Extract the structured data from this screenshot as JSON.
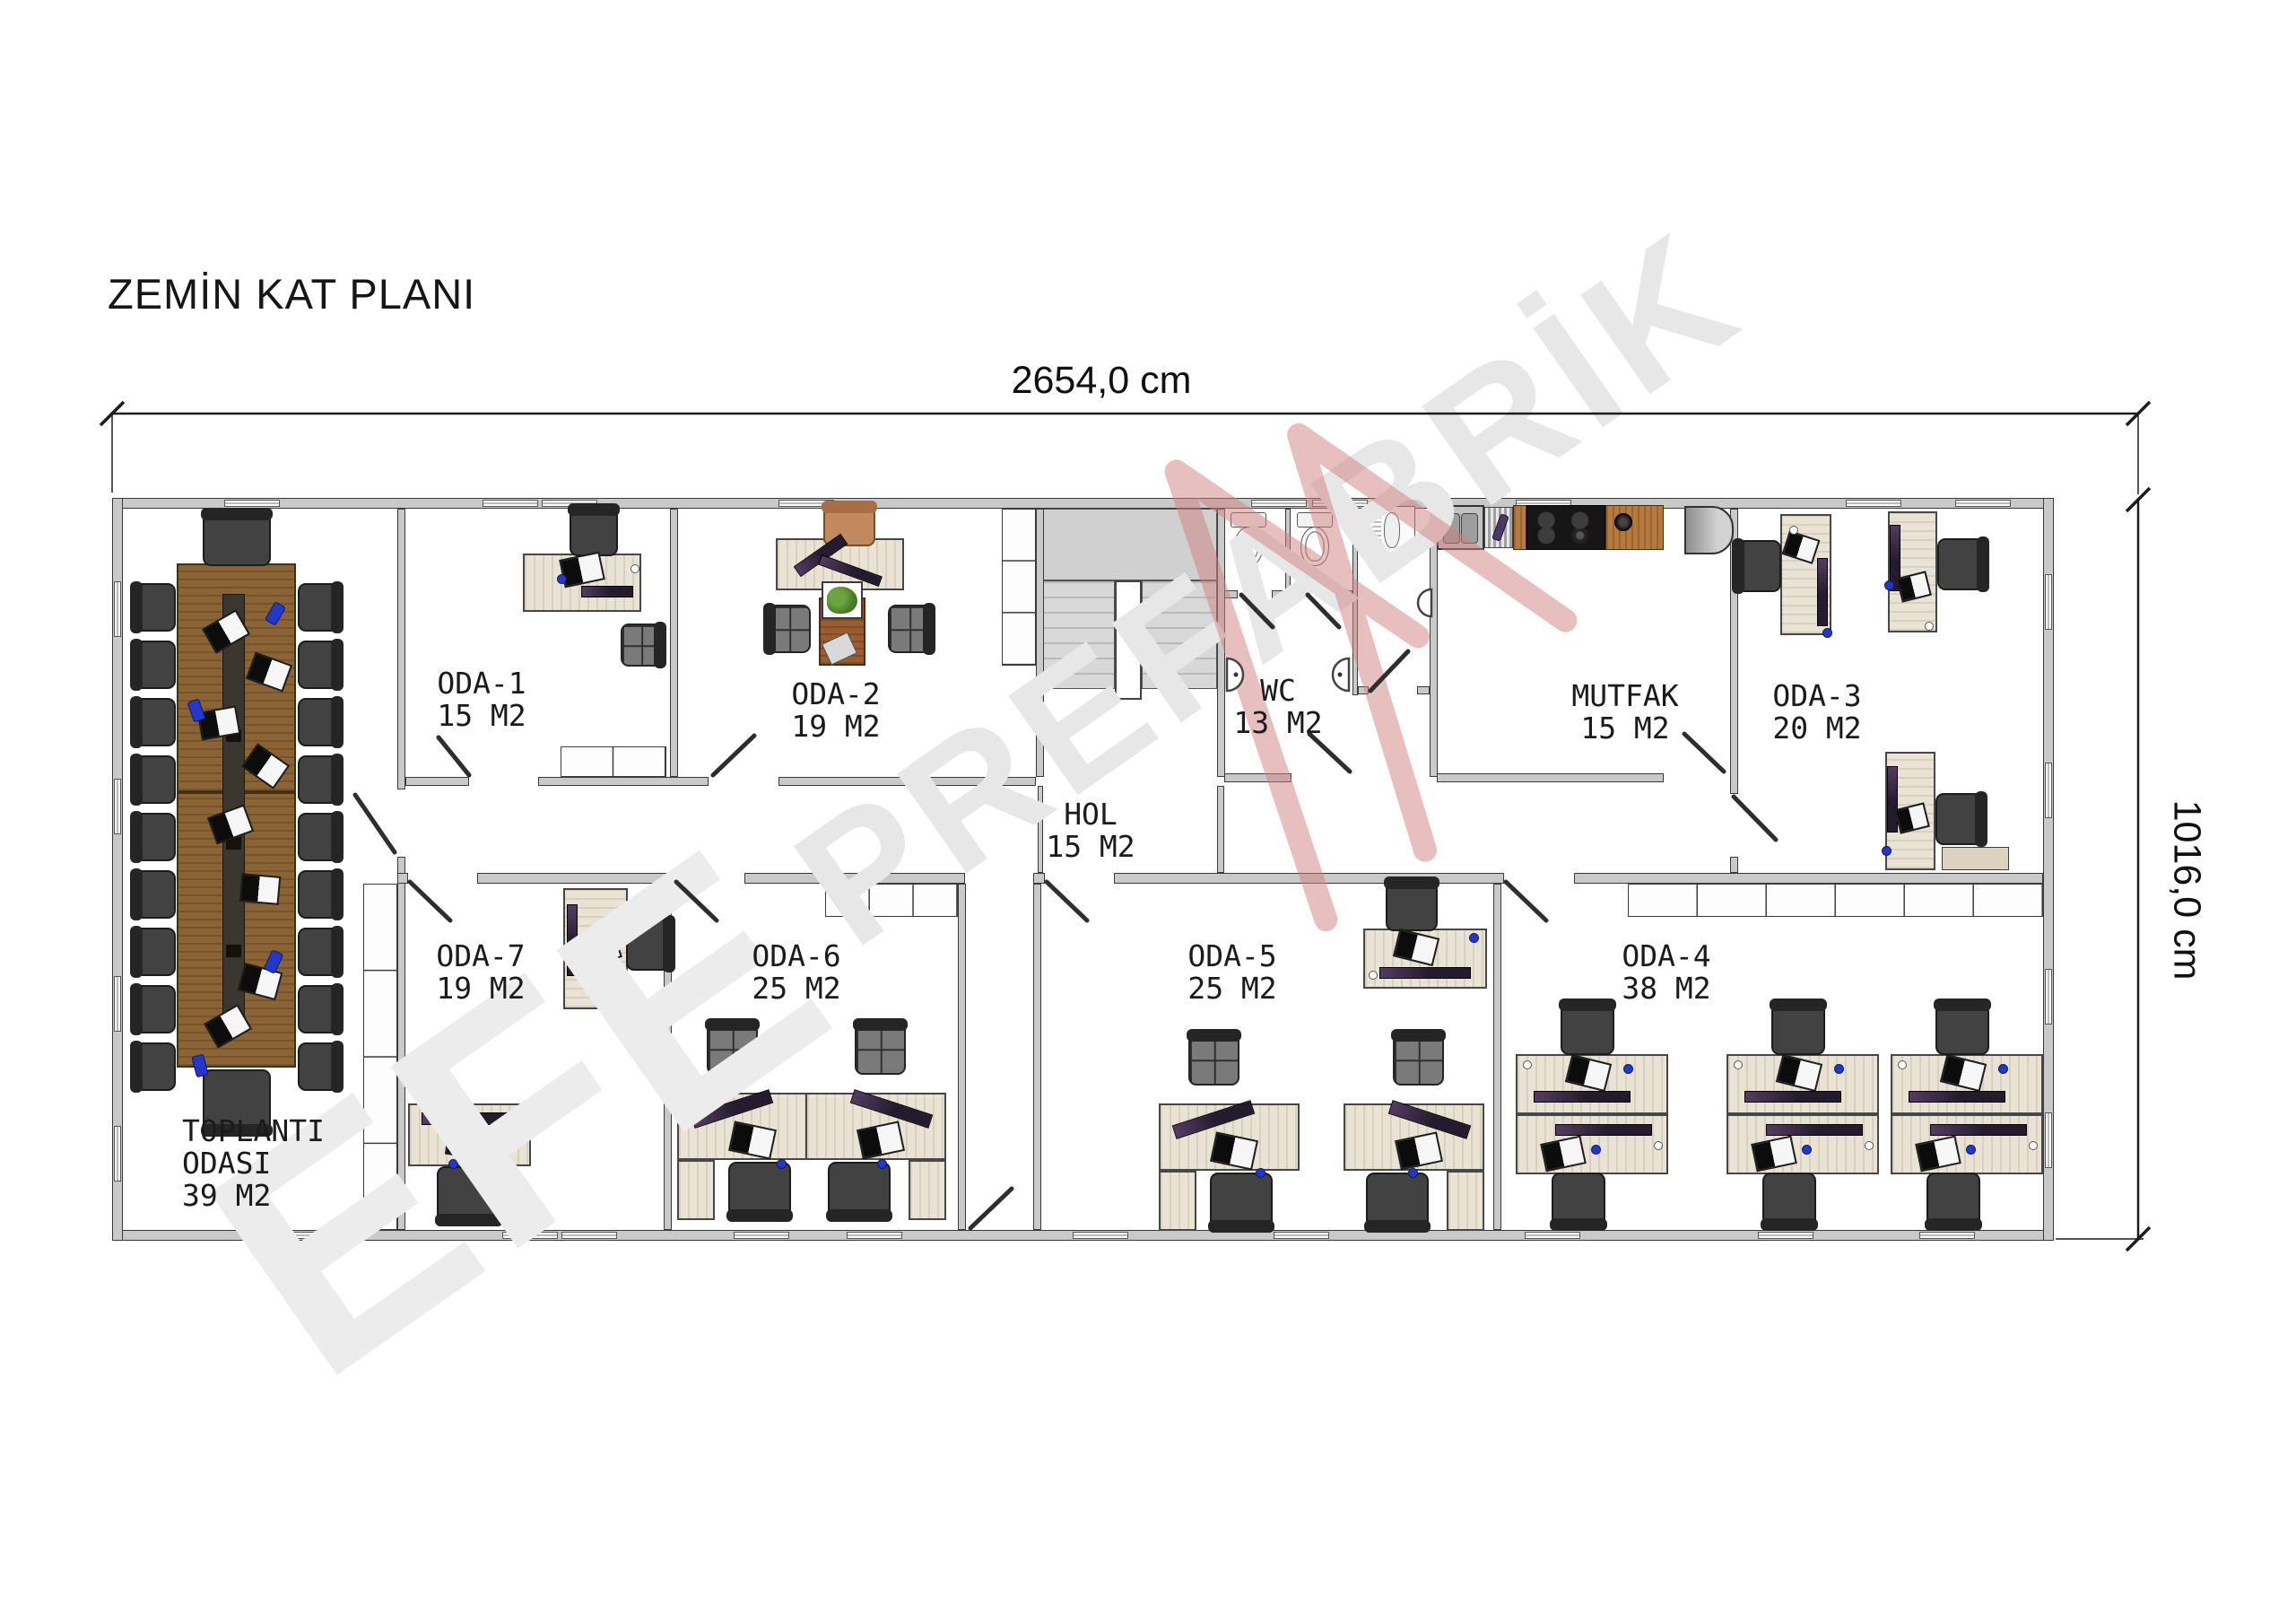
{
  "title": "ZEMİN KAT PLANI",
  "dimensions": {
    "width_label": "2654,0 cm",
    "height_label": "1016,0 cm"
  },
  "watermark": {
    "brand_primary": "EFE",
    "brand_secondary": "PREFABRİK"
  },
  "rooms": [
    {
      "id": "toplanti",
      "name": "TOPLANTI",
      "name2": "ODASI",
      "area": "39 M2"
    },
    {
      "id": "oda1",
      "name": "ODA-1",
      "area": "15 M2"
    },
    {
      "id": "oda2",
      "name": "ODA-2",
      "area": "19 M2"
    },
    {
      "id": "hol",
      "name": "HOL",
      "area": "15 M2"
    },
    {
      "id": "wc",
      "name": "WC",
      "area": "13 M2"
    },
    {
      "id": "mutfak",
      "name": "MUTFAK",
      "area": "15 M2"
    },
    {
      "id": "oda3",
      "name": "ODA-3",
      "area": "20 M2"
    },
    {
      "id": "oda7",
      "name": "ODA-7",
      "area": "19 M2"
    },
    {
      "id": "oda6",
      "name": "ODA-6",
      "area": "25 M2"
    },
    {
      "id": "oda5",
      "name": "ODA-5",
      "area": "25 M2"
    },
    {
      "id": "oda4",
      "name": "ODA-4",
      "area": "38 M2"
    }
  ]
}
